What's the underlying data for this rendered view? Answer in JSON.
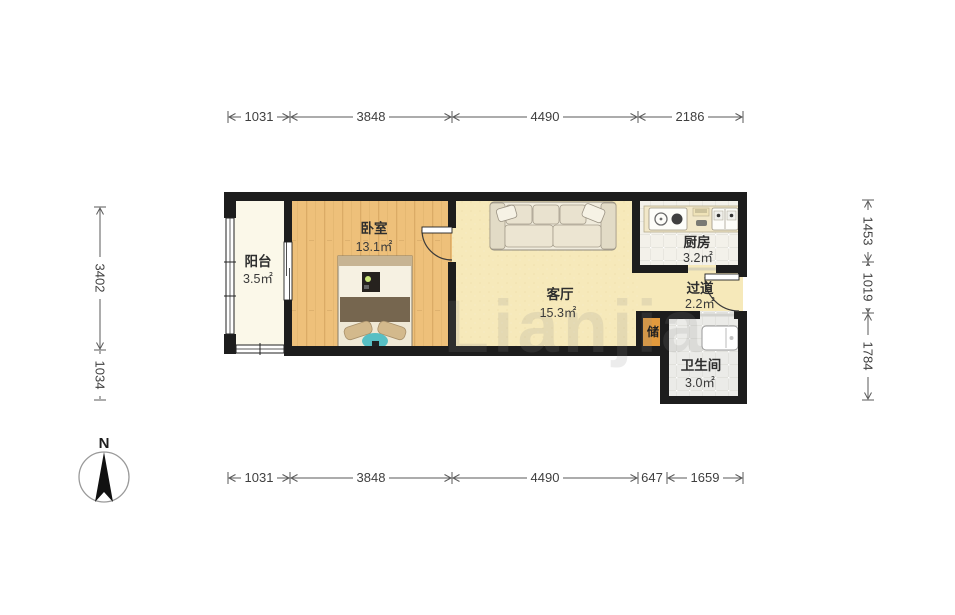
{
  "rooms": {
    "balcony": {
      "name": "阳台",
      "area": "3.5㎡"
    },
    "bedroom": {
      "name": "卧室",
      "area": "13.1㎡"
    },
    "living": {
      "name": "客厅",
      "area": "15.3㎡"
    },
    "kitchen": {
      "name": "厨房",
      "area": "3.2㎡"
    },
    "hallway": {
      "name": "过道",
      "area": "2.2㎡"
    },
    "storage": {
      "name": "储"
    },
    "bathroom": {
      "name": "卫生间",
      "area": "3.0㎡"
    }
  },
  "dimensions": {
    "top": [
      "1031",
      "3848",
      "4490",
      "2186"
    ],
    "bottom": [
      "1031",
      "3848",
      "4490",
      "647",
      "1659"
    ],
    "left": [
      "3402",
      "1034"
    ],
    "right": [
      "1453",
      "1019",
      "1784"
    ]
  },
  "compass": {
    "north_label": "N"
  },
  "watermark": {
    "text": "Lianjia"
  },
  "colors": {
    "wall": "#1d1d1d",
    "balcony_floor": "#fbf8e9",
    "bedroom_floor": "#eec07a",
    "living_floor": "#f6e9ba",
    "kitchen_floor": "#f3f1ea",
    "bath_floor": "#ebebe8",
    "storage_fill": "#e29a3d"
  }
}
